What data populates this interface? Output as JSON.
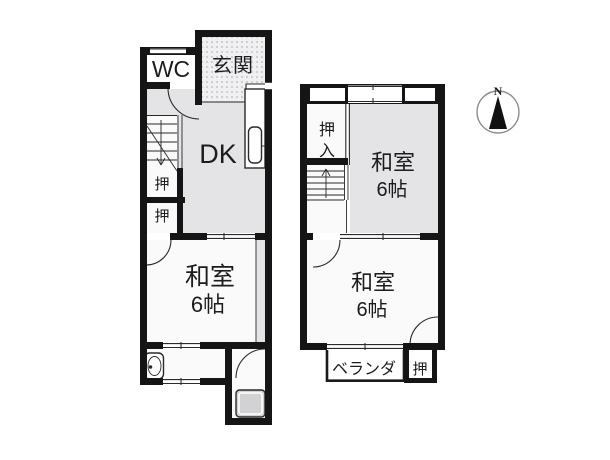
{
  "colors": {
    "background": "#ffffff",
    "wall": "#151515",
    "line": "#2a2a2a",
    "floor_gray": "#e4e4e7",
    "floor_white": "#fafafa",
    "bath_fill": "#d2d2d5",
    "genkan_bg": "#f0f0f2",
    "genkan_dot": "#b8b8bc",
    "compass_ring": "#8d8d8d",
    "text": "#1c1c1c"
  },
  "floor1": {
    "rooms": {
      "wc": {
        "label": "WC"
      },
      "genkan": {
        "label": "玄関"
      },
      "dk": {
        "label": "DK"
      },
      "closet_upper": {
        "label": "押"
      },
      "closet_lower": {
        "label": "押"
      },
      "washitsu": {
        "label": "和室",
        "size": "6帖"
      }
    }
  },
  "floor2": {
    "rooms": {
      "oshiire": {
        "label": "押入",
        "char_top": "押",
        "char_bottom": "入"
      },
      "washitsu_north": {
        "label": "和室",
        "size": "6帖"
      },
      "washitsu_south": {
        "label": "和室",
        "size": "6帖"
      },
      "veranda": {
        "label": "ベランダ"
      },
      "closet": {
        "label": "押"
      }
    }
  },
  "compass": {
    "north_label": "N"
  }
}
